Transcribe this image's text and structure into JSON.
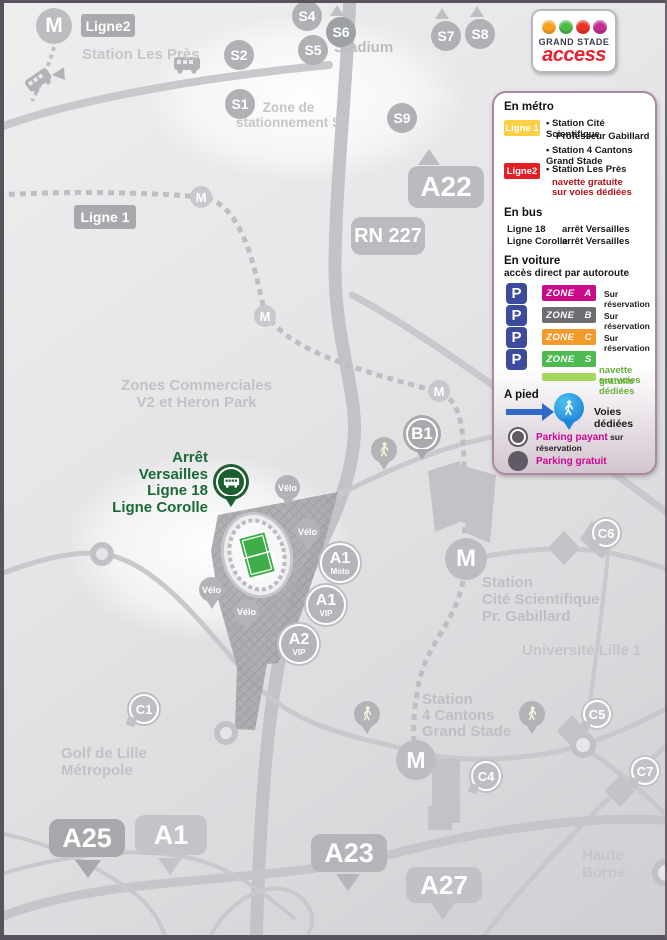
{
  "logo": {
    "title": "GRAND STADE",
    "subtitle": "access",
    "icon_colors": [
      "#f5a11c",
      "#4cb847",
      "#e63323",
      "#c12f93"
    ]
  },
  "legend": {
    "metro": {
      "heading": "En métro",
      "line1_badge": "Ligne 1",
      "line1_color": "#fccf44",
      "line1_stop1a": "• Station Cité Scientifique",
      "line1_stop1b": "Professeur Gabillard",
      "line1_stop2": "• Station 4 Cantons Grand Stade",
      "line2_badge": "Ligne2",
      "line2_color": "#e31e24",
      "line2_stop": "• Station Les Près",
      "line2_note1": "navette gratuite",
      "line2_note2": "sur voies dédiées"
    },
    "bus": {
      "heading": "En bus",
      "rows": [
        {
          "line": "Ligne 18",
          "stop": "arrêt Versailles"
        },
        {
          "line": "Ligne Corolle",
          "stop": "arrêt Versailles"
        }
      ]
    },
    "car": {
      "heading": "En voiture",
      "subheading": "accès direct par autoroute",
      "p": "P",
      "p_color": "#3c4b9e",
      "zones": [
        {
          "label": "ZONE A",
          "color": "#cb0a8b",
          "note": "Sur réservation"
        },
        {
          "label": "ZONE B",
          "color": "#6d6d72",
          "note": "Sur réservation"
        },
        {
          "label": "ZONE C",
          "color": "#f5992b",
          "note": "Sur réservation"
        },
        {
          "label": "ZONE S",
          "color": "#4fba50",
          "note": ""
        }
      ],
      "zone_s_note1": "navette gratuite",
      "zone_s_note2": "sur voies dédiées",
      "zone_s_bar_color": "#a5d75f"
    },
    "walk": {
      "heading": "A pied",
      "label": "Voies dédiées",
      "arrow_color": "#2f6bc6"
    },
    "parking": {
      "paid_label": "Parking payant",
      "paid_suffix": " sur réservation",
      "free_label": "Parking gratuit",
      "accent_color": "#cc0793"
    }
  },
  "map": {
    "metro_m": "M",
    "ligne1_badge": "Ligne 1",
    "ligne2_badge": "Ligne2",
    "roads": {
      "a22": "A22",
      "rn227": "RN 227",
      "a25": "A25",
      "a1": "A1",
      "a23": "A23",
      "a27": "A27"
    },
    "s_stops": [
      "S1",
      "S2",
      "S4",
      "S5",
      "S6",
      "S7",
      "S8",
      "S9"
    ],
    "c_parkings": [
      "C1",
      "C4",
      "C5",
      "C6",
      "C7"
    ],
    "gates": [
      {
        "top": "A1",
        "sub": "Moto"
      },
      {
        "top": "A1",
        "sub": "VIP"
      },
      {
        "top": "A2",
        "sub": "VIP"
      }
    ],
    "b1": "B1",
    "velo": "Vélo",
    "arret_line1": "Arrêt Versailles",
    "arret_line2": "Ligne 18",
    "arret_line3": "Ligne Corolle",
    "arret_color": "#1b6a35",
    "pitch_color": "#3fae49",
    "places": {
      "station_les_pres": "Station Les Près",
      "zone_s1": "Zone de",
      "zone_s2": "stationnement S",
      "stadium": "Stadium",
      "zc1": "Zones Commerciales",
      "zc2": "V2 et Heron Park",
      "cite1": "Station",
      "cite2": "Cité Scientifique",
      "cite3": "Pr. Gabillard",
      "universite": "Université Lille 1",
      "cantons1": "Station",
      "cantons2": "4 Cantons",
      "cantons3": "Grand Stade",
      "golf1": "Golf de Lille",
      "golf2": "Métropole",
      "haute_borne": "Haute Borne"
    }
  }
}
